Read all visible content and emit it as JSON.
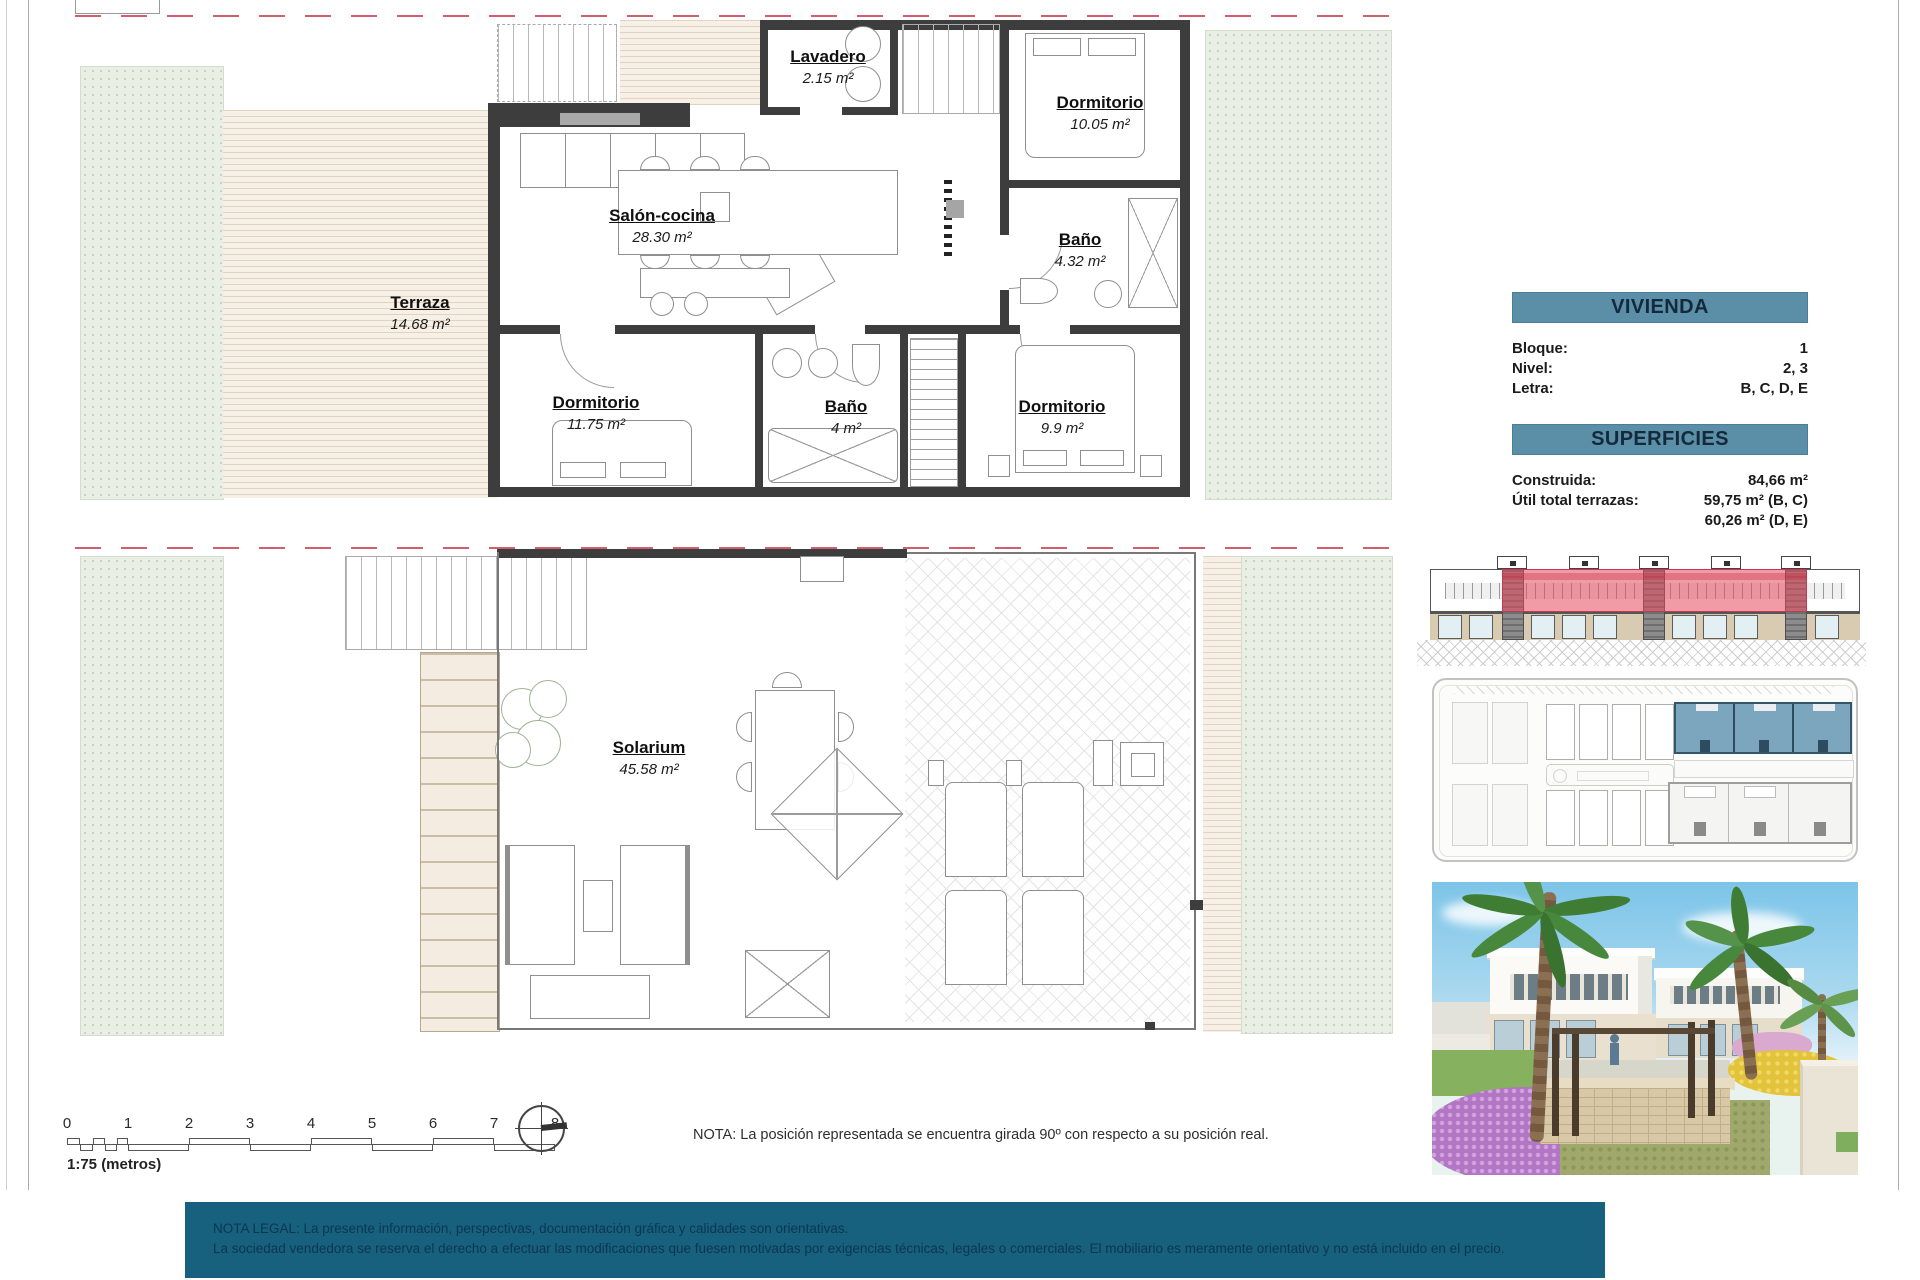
{
  "plans": {
    "upper": {
      "terraza": {
        "name": "Terraza",
        "area": "14.68 m²"
      },
      "salon": {
        "name": "Salón-cocina",
        "area": "28.30 m²"
      },
      "lavadero": {
        "name": "Lavadero",
        "area": "2.15 m²"
      },
      "dorm1": {
        "name": "Dormitorio",
        "area": "10.05 m²"
      },
      "bano1": {
        "name": "Baño",
        "area": "4.32 m²"
      },
      "dorm2": {
        "name": "Dormitorio",
        "area": "11.75 m²"
      },
      "bano2": {
        "name": "Baño",
        "area": "4 m²"
      },
      "dorm3": {
        "name": "Dormitorio",
        "area": "9.9 m²"
      }
    },
    "lower": {
      "solarium": {
        "name": "Solarium",
        "area": "45.58 m²"
      }
    }
  },
  "info": {
    "vivienda_title": "VIVIENDA",
    "rows": [
      {
        "label": "Bloque:",
        "value": "1"
      },
      {
        "label": "Nivel:",
        "value": "2, 3"
      },
      {
        "label": "Letra:",
        "value": "B, C, D, E"
      }
    ],
    "superficies_title": "SUPERFICIES",
    "superficie_rows": [
      {
        "label": "Construida:",
        "value": "84,66 m²"
      },
      {
        "label": "Útil total terrazas:",
        "value": "59,75 m² (B, C)"
      },
      {
        "label": "",
        "value": "60,26 m² (D, E)"
      }
    ]
  },
  "scalebar": {
    "ticks": [
      "0",
      "1",
      "2",
      "3",
      "4",
      "5",
      "6",
      "7",
      "8"
    ],
    "label": "1:75 (metros)"
  },
  "notes": {
    "nota": "NOTA: La posición representada se encuentra girada 90º con respecto a su posición real.",
    "legal1": "NOTA LEGAL: La presente información, perspectivas, documentación gráfica y calidades son orientativas.",
    "legal2": "La sociedad vendedora se reserva el derecho a efectuar las modificaciones que fuesen motivadas por exigencias técnicas, legales o comerciales. El mobiliario es meramente orientativo y no está incluido en el precio."
  },
  "colors": {
    "accent_teal": "#5b8ea7",
    "legal_bg": "#17617f",
    "highlight_red": "#e0556e",
    "highlight_blue": "#7ba6bd",
    "wall": "#3d3d3d"
  }
}
